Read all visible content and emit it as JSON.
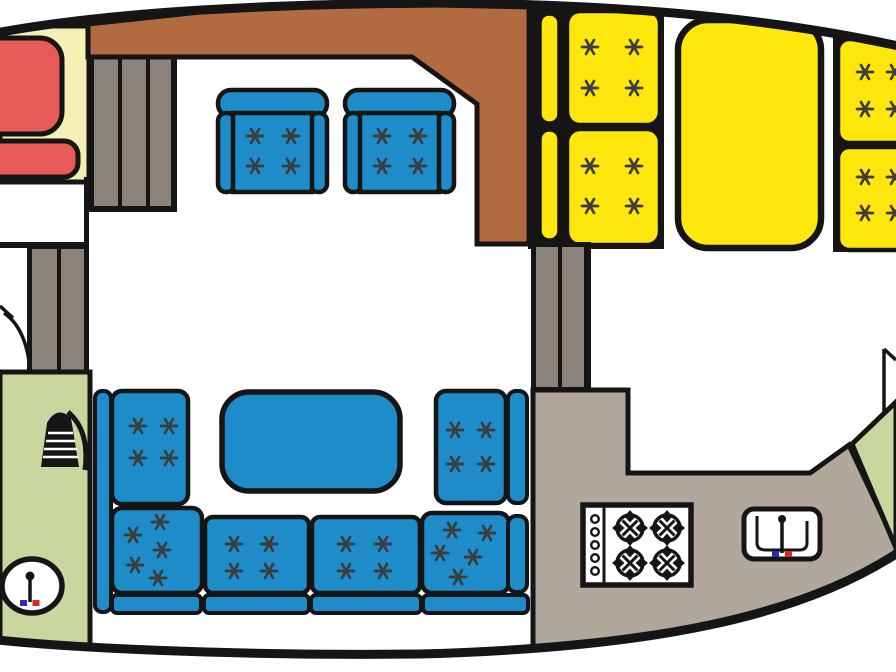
{
  "image": {
    "type": "boat-interior-floor-plan",
    "width": 896,
    "height": 672
  },
  "colors": {
    "ink": "#151515",
    "floor_white": "#ffffff",
    "cabin_cream": "#f4efb5",
    "mattress_red": "#e85a57",
    "deck_brown": "#b26b41",
    "locker_gray": "#8b837a",
    "upholstery_blue": "#1d8cc8",
    "berth_yellow": "#ffe70d",
    "head_green": "#c9d79e",
    "galley_taupe": "#b1a79b",
    "tuft_dark": "#3c3c3c",
    "hot_tap_red": "#e02421",
    "cold_tap_blue": "#2b2bbd"
  },
  "areas": {
    "forward_cabin": {
      "furniture": [
        "red-double-berth",
        "red-foot-cushion"
      ],
      "floor": "cabin_cream"
    },
    "forward_companionway": {
      "furniture": [
        "three-tread-steps"
      ]
    },
    "side_deck": {
      "floor": "deck_brown"
    },
    "salon_upper": {
      "furniture": [
        "armchair",
        "armchair"
      ],
      "tufts_per_armchair": 4
    },
    "midship_bunks": {
      "berths": 2,
      "pillows": 2,
      "tufts_per_berth": 4
    },
    "aft_double_berth": {
      "berths": 1
    },
    "aft_quarter_bunks": {
      "berths": 2,
      "tufts_per_berth": 4,
      "clipped_at_right_edge": true
    },
    "forward_head": {
      "floor": "head_green",
      "fixtures": [
        "shower",
        "toilet-basin"
      ]
    },
    "salon_lower": {
      "furniture": [
        "u-shaped-sofa",
        "dinette-table"
      ],
      "sofa_back_cushions": 6,
      "sofa_seat_strips": 4
    },
    "galley": {
      "floor": "galley_taupe",
      "fixtures": [
        "four-burner-stove",
        "sink"
      ],
      "stove_burners": 4,
      "stove_knobs": 5
    },
    "aft_head": {
      "floor": "head_green",
      "fixtures": [
        "door"
      ]
    }
  }
}
